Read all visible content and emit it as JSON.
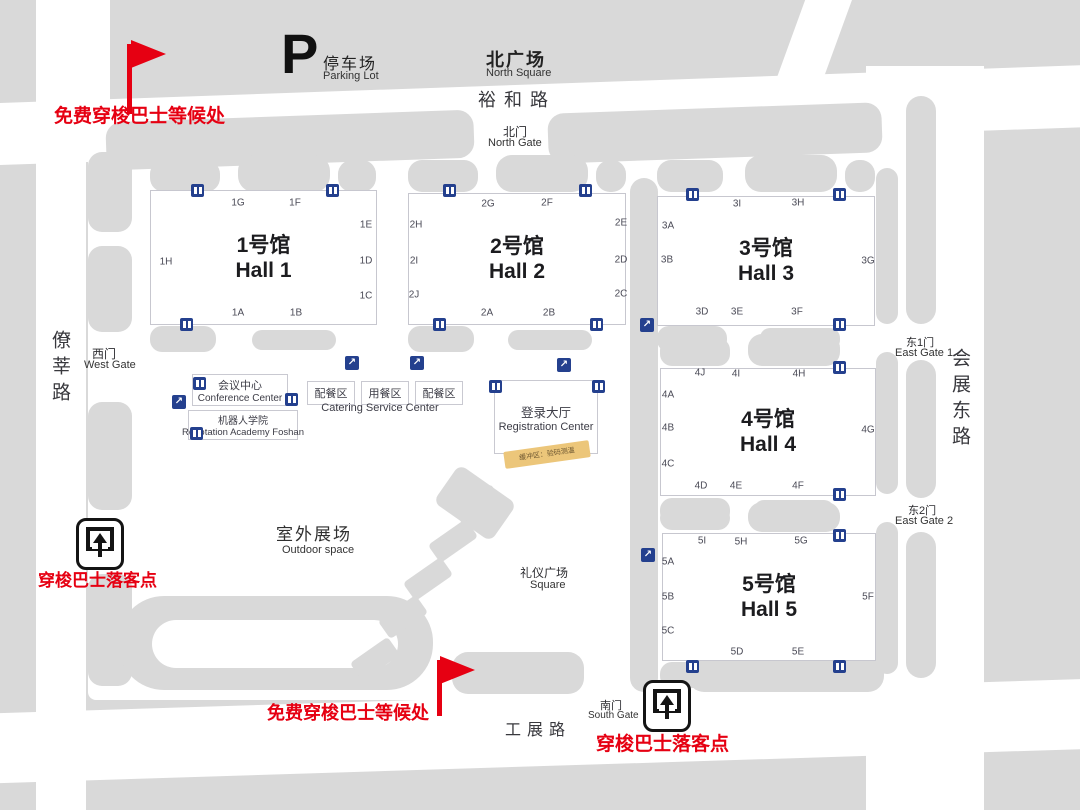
{
  "colors": {
    "background": "#d9d9d9",
    "road": "#ffffff",
    "accent_red": "#e60012",
    "icon_blue": "#24408e",
    "banner_yellow": "#ecc67a"
  },
  "roads": {
    "north": "裕和路",
    "west": "僚莘路",
    "east": "会展东路",
    "south": "工展路"
  },
  "landmarks": {
    "parking": {
      "symbol": "P",
      "zh": "停车场",
      "en": "Parking Lot"
    },
    "north_square": {
      "zh": "北广场",
      "en": "North Square"
    },
    "north_gate": {
      "zh": "北门",
      "en": "North Gate"
    },
    "west_gate": {
      "zh": "西门",
      "en": "West Gate"
    },
    "east_gate_1": {
      "zh": "东1门",
      "en": "East Gate 1"
    },
    "east_gate_2": {
      "zh": "东2门",
      "en": "East Gate 2"
    },
    "south_gate": {
      "zh": "南门",
      "en": "South Gate"
    },
    "outdoor_space": {
      "zh": "室外展场",
      "en": "Outdoor space"
    },
    "ceremony_square": {
      "zh": "礼仪广场",
      "en": "Square"
    },
    "conference_center": {
      "zh": "会议中心",
      "en": "Conference Center"
    },
    "robotation_academy": {
      "zh": "机器人学院",
      "en": "Robotation Academy Foshan"
    },
    "catering": {
      "box1": "配餐区",
      "box2": "用餐区",
      "box3": "配餐区",
      "en": "Catering Service Center"
    },
    "registration": {
      "zh": "登录大厅",
      "en": "Registration Center"
    },
    "buffer_banner": "缓冲区：验码测温"
  },
  "annotations": {
    "shuttle_wait_top": "免费穿梭巴士等候处",
    "shuttle_wait_bottom": "免费穿梭巴士等候处",
    "shuttle_drop_left": "穿梭巴士落客点",
    "shuttle_drop_right": "穿梭巴士落客点"
  },
  "halls": [
    {
      "id": "hall-1",
      "zh": "1号馆",
      "en": "Hall 1",
      "x": 150,
      "y": 190,
      "w": 225,
      "h": 133,
      "gates": [
        {
          "id": "1G",
          "x": 238,
          "y": 203
        },
        {
          "id": "1F",
          "x": 295,
          "y": 203
        },
        {
          "id": "1E",
          "x": 366,
          "y": 225
        },
        {
          "id": "1D",
          "x": 366,
          "y": 261
        },
        {
          "id": "1C",
          "x": 366,
          "y": 296
        },
        {
          "id": "1H",
          "x": 166,
          "y": 262
        },
        {
          "id": "1A",
          "x": 238,
          "y": 313
        },
        {
          "id": "1B",
          "x": 296,
          "y": 313
        }
      ]
    },
    {
      "id": "hall-2",
      "zh": "2号馆",
      "en": "Hall 2",
      "x": 408,
      "y": 193,
      "w": 216,
      "h": 130,
      "gates": [
        {
          "id": "2G",
          "x": 488,
          "y": 204
        },
        {
          "id": "2F",
          "x": 547,
          "y": 203
        },
        {
          "id": "2E",
          "x": 621,
          "y": 223
        },
        {
          "id": "2D",
          "x": 621,
          "y": 260
        },
        {
          "id": "2C",
          "x": 621,
          "y": 294
        },
        {
          "id": "2H",
          "x": 416,
          "y": 225
        },
        {
          "id": "2I",
          "x": 414,
          "y": 261
        },
        {
          "id": "2J",
          "x": 414,
          "y": 295
        },
        {
          "id": "2A",
          "x": 487,
          "y": 313
        },
        {
          "id": "2B",
          "x": 549,
          "y": 313
        }
      ]
    },
    {
      "id": "hall-3",
      "zh": "3号馆",
      "en": "Hall 3",
      "x": 657,
      "y": 196,
      "w": 216,
      "h": 128,
      "gates": [
        {
          "id": "3I",
          "x": 737,
          "y": 204
        },
        {
          "id": "3H",
          "x": 798,
          "y": 203
        },
        {
          "id": "3A",
          "x": 668,
          "y": 226
        },
        {
          "id": "3B",
          "x": 667,
          "y": 260
        },
        {
          "id": "3G",
          "x": 868,
          "y": 261
        },
        {
          "id": "3D",
          "x": 702,
          "y": 312
        },
        {
          "id": "3E",
          "x": 737,
          "y": 312
        },
        {
          "id": "3F",
          "x": 797,
          "y": 312
        }
      ]
    },
    {
      "id": "hall-4",
      "zh": "4号馆",
      "en": "Hall 4",
      "x": 660,
      "y": 368,
      "w": 214,
      "h": 126,
      "gates": [
        {
          "id": "4J",
          "x": 700,
          "y": 373
        },
        {
          "id": "4I",
          "x": 736,
          "y": 374
        },
        {
          "id": "4H",
          "x": 799,
          "y": 374
        },
        {
          "id": "4A",
          "x": 668,
          "y": 395
        },
        {
          "id": "4B",
          "x": 668,
          "y": 428
        },
        {
          "id": "4C",
          "x": 668,
          "y": 464
        },
        {
          "id": "4G",
          "x": 868,
          "y": 430
        },
        {
          "id": "4D",
          "x": 701,
          "y": 486
        },
        {
          "id": "4E",
          "x": 736,
          "y": 486
        },
        {
          "id": "4F",
          "x": 798,
          "y": 486
        }
      ]
    },
    {
      "id": "hall-5",
      "zh": "5号馆",
      "en": "Hall 5",
      "x": 662,
      "y": 533,
      "w": 212,
      "h": 126,
      "gates": [
        {
          "id": "5I",
          "x": 702,
          "y": 541
        },
        {
          "id": "5H",
          "x": 741,
          "y": 542
        },
        {
          "id": "5G",
          "x": 801,
          "y": 541
        },
        {
          "id": "5A",
          "x": 668,
          "y": 562
        },
        {
          "id": "5B",
          "x": 668,
          "y": 597
        },
        {
          "id": "5C",
          "x": 668,
          "y": 631
        },
        {
          "id": "5F",
          "x": 868,
          "y": 597
        },
        {
          "id": "5D",
          "x": 737,
          "y": 652
        },
        {
          "id": "5E",
          "x": 798,
          "y": 652
        }
      ]
    }
  ],
  "icons": {
    "escalator_glyph": "↗",
    "doors": [
      [
        191,
        184
      ],
      [
        326,
        184
      ],
      [
        180,
        318
      ],
      [
        443,
        184
      ],
      [
        579,
        184
      ],
      [
        433,
        318
      ],
      [
        590,
        318
      ],
      [
        686,
        188
      ],
      [
        833,
        188
      ],
      [
        833,
        318
      ],
      [
        833,
        361
      ],
      [
        833,
        488
      ],
      [
        833,
        529
      ],
      [
        686,
        660
      ],
      [
        833,
        660
      ],
      [
        193,
        377
      ],
      [
        285,
        393
      ],
      [
        190,
        427
      ],
      [
        489,
        380
      ],
      [
        592,
        380
      ]
    ],
    "escalators": [
      [
        172,
        395
      ],
      [
        345,
        356
      ],
      [
        410,
        356
      ],
      [
        557,
        358
      ],
      [
        640,
        318
      ],
      [
        641,
        548
      ]
    ]
  }
}
